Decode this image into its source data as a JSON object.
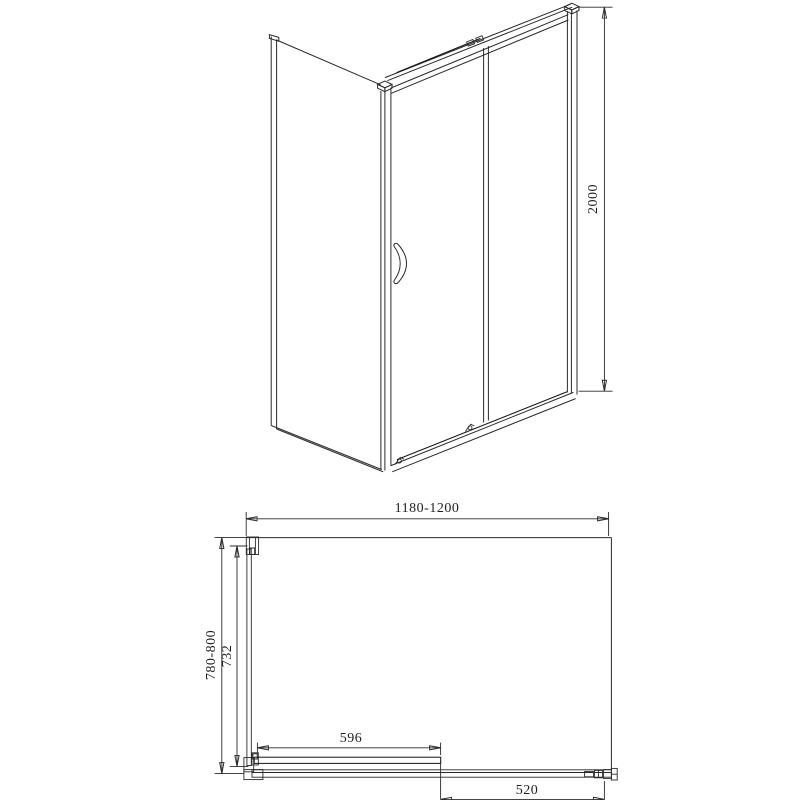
{
  "colors": {
    "background": "#ffffff",
    "line": "#2a2a2a",
    "panel_fill": "#a9a9a9",
    "door_fill": "#4a4a4a",
    "track_fill": "#f1f1f1"
  },
  "front_view": {
    "dimensions": {
      "height": "2000"
    }
  },
  "plan_view": {
    "dimensions": {
      "overall_width": "1180-1200",
      "overall_depth": "780-800",
      "side_panel_glass_depth": "732",
      "sliding_door_width": "596",
      "fixed_section_width": "520"
    }
  }
}
